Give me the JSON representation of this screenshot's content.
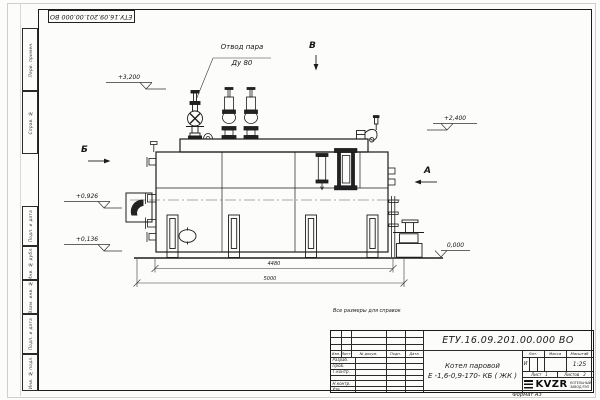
{
  "sheet": {
    "format_label": "Формат А3",
    "reference_note": "Все размеры для справок"
  },
  "margin": {
    "top_stamp": "ЕТУ.16.09.201.00.000 ВО",
    "boxes_top": [
      "Перв. примен.",
      "Справ. №"
    ],
    "boxes_bottom": [
      "Подп. и дата",
      "Инв. № дубл.",
      "Взам. инв. №",
      "Подп. и дата",
      "Инв. № подл."
    ]
  },
  "annotations": {
    "steam_outlet_line1": "Отвод пара",
    "steam_outlet_line2": "Ду 80",
    "view_b": "В",
    "view_b_side": "Б",
    "view_a": "А",
    "elev_3200": "+3,200",
    "elev_2400": "+2,400",
    "elev_0926": "+0,926",
    "elev_0136": "+0,136",
    "elev_0000": "0,000",
    "dim_inner": "4480",
    "dim_outer": "5000"
  },
  "title_block": {
    "doc_number": "ЕТУ.16.09.201.00.000  ВО",
    "product_line1": "Котел паровой",
    "product_line2": "Е -1,6-0,9-170- КБ ( ЖК )",
    "rev_headers": [
      "Изм.",
      "Лист",
      "№ докум.",
      "Подп.",
      "Дата"
    ],
    "sig_rows": [
      "Разраб.",
      "Пров.",
      "Т.контр.",
      "",
      "Н.контр.",
      "Утв."
    ],
    "lit_label": "Лит.",
    "lit_value": "И",
    "mass_label": "Масса",
    "scale_label": "Масштаб",
    "scale_value": "1:25",
    "sheet_label": "Лист",
    "sheet_value": "1",
    "sheets_label": "Листов",
    "sheets_value": "2",
    "logo_text": "KVZR",
    "logo_line1": "КОТЕЛЬНЫЙ",
    "logo_line2": "ЗАВОД РЭП"
  }
}
